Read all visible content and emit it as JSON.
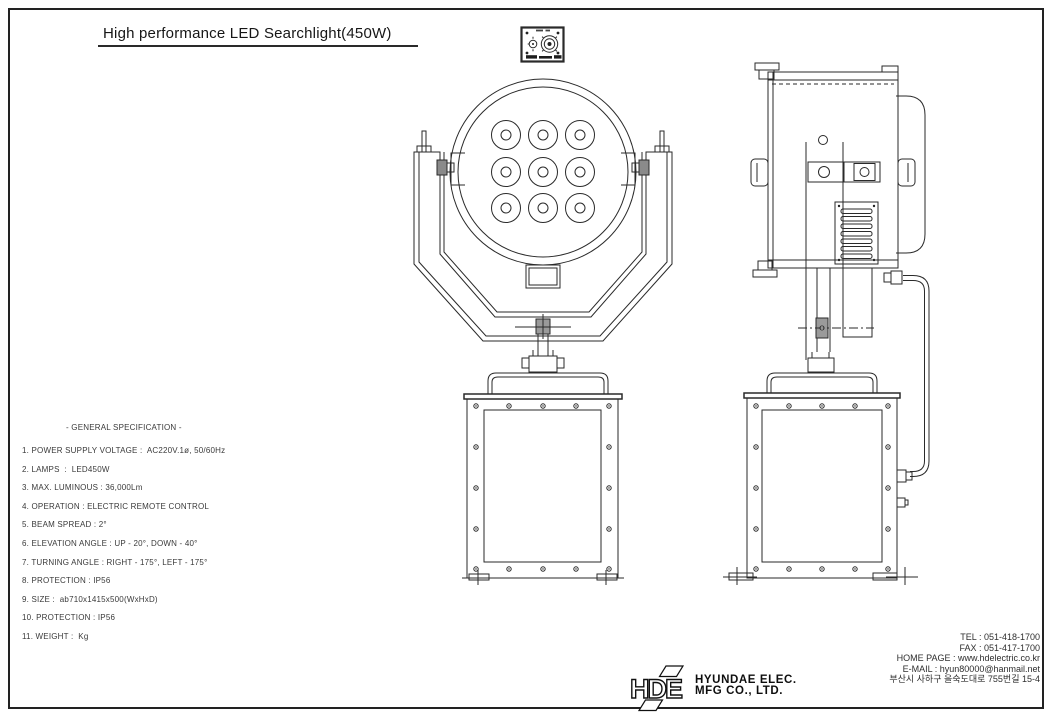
{
  "sheet": {
    "title": "High performance LED Searchlight(450W)"
  },
  "specifications": {
    "heading": "- GENERAL SPECIFICATION -",
    "items": [
      "1. POWER SUPPLY VOLTAGE :  AC220V.1ø, 50/60Hz",
      "2. LAMPS  :  LED450W",
      "3. MAX. LUMINOUS : 36,000Lm",
      "4. OPERATION : ELECTRIC REMOTE CONTROL",
      "5. BEAM SPREAD : 2°",
      "6. ELEVATION ANGLE : UP - 20°, DOWN - 40°",
      "7. TURNING ANGLE : RIGHT - 175°, LEFT - 175°",
      "8. PROTECTION : IP56",
      "9. SIZE :  ab710x1415x500(WxHxD)",
      "10. PROTECTION : IP56",
      "11. WEIGHT :  Kg"
    ]
  },
  "contact": {
    "tel": "TEL : 051-418-1700",
    "fax": "FAX : 051-417-1700",
    "homepage": "HOME PAGE : www.hdelectric.co.kr",
    "email": "E-MAIL : hyun80000@hanmail.net",
    "address": "부산시 사하구 을숙도대로 755번길 15-4"
  },
  "logo": {
    "monogram": "HDE",
    "company_line1": "HYUNDAE ELEC.",
    "company_line2": "MFG CO., LTD."
  },
  "drawing": {
    "line_color": "#2a2a2a",
    "led_count": 9,
    "views": [
      "top-connector-plate",
      "front-view",
      "side-view"
    ]
  }
}
